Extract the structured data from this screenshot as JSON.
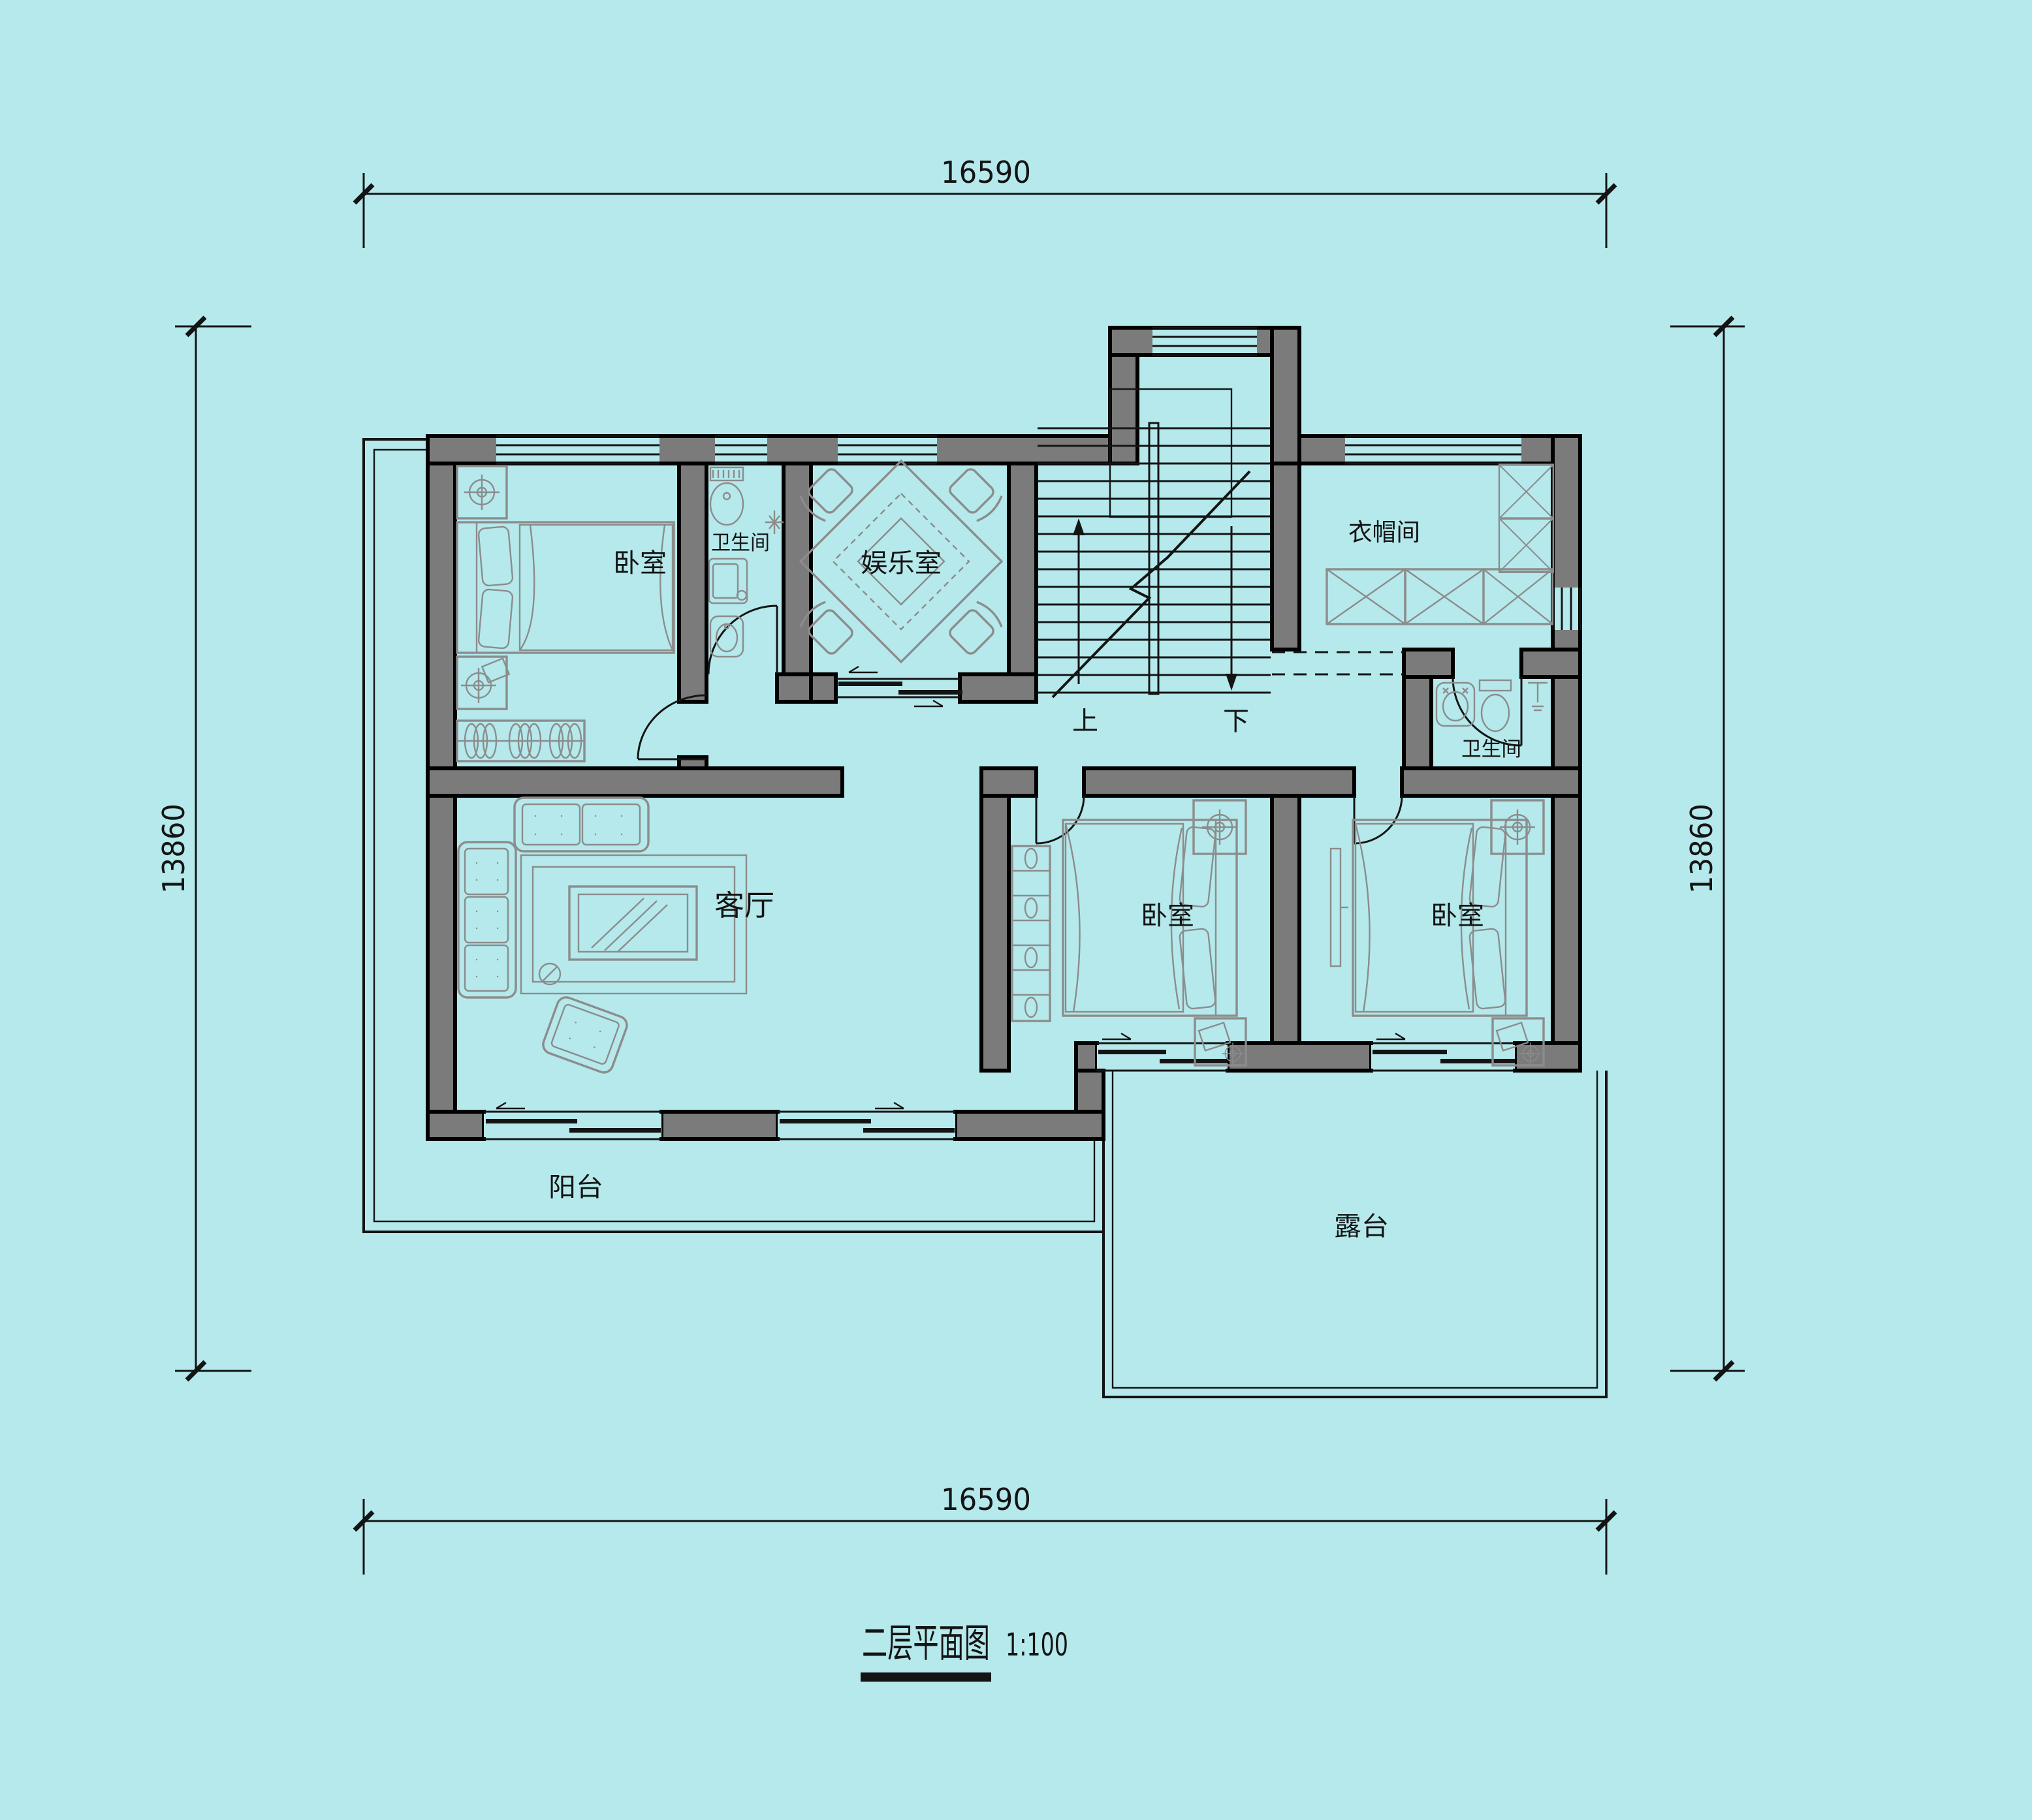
{
  "title": {
    "name": "二层平面图",
    "scale": "1:100"
  },
  "dimensions": {
    "top": "16590",
    "bottom": "16590",
    "left": "13860",
    "right": "13860"
  },
  "rooms": {
    "bedroom_nw": "卧室",
    "bathroom_n": "卫生间",
    "entertainment": "娱乐室",
    "cloakroom": "衣帽间",
    "bathroom_e": "卫生间",
    "bedroom_mid": "卧室",
    "bedroom_e": "卧室",
    "living": "客厅",
    "balcony": "阳台",
    "terrace": "露台"
  },
  "stairs": {
    "up": "上",
    "down": "下"
  },
  "colors": {
    "background": "#b5e9ec",
    "wall_fill": "#7b7b7b",
    "wall_stroke": "#000000",
    "furniture": "#8c8c8c",
    "line": "#141414",
    "text": "#141414"
  }
}
